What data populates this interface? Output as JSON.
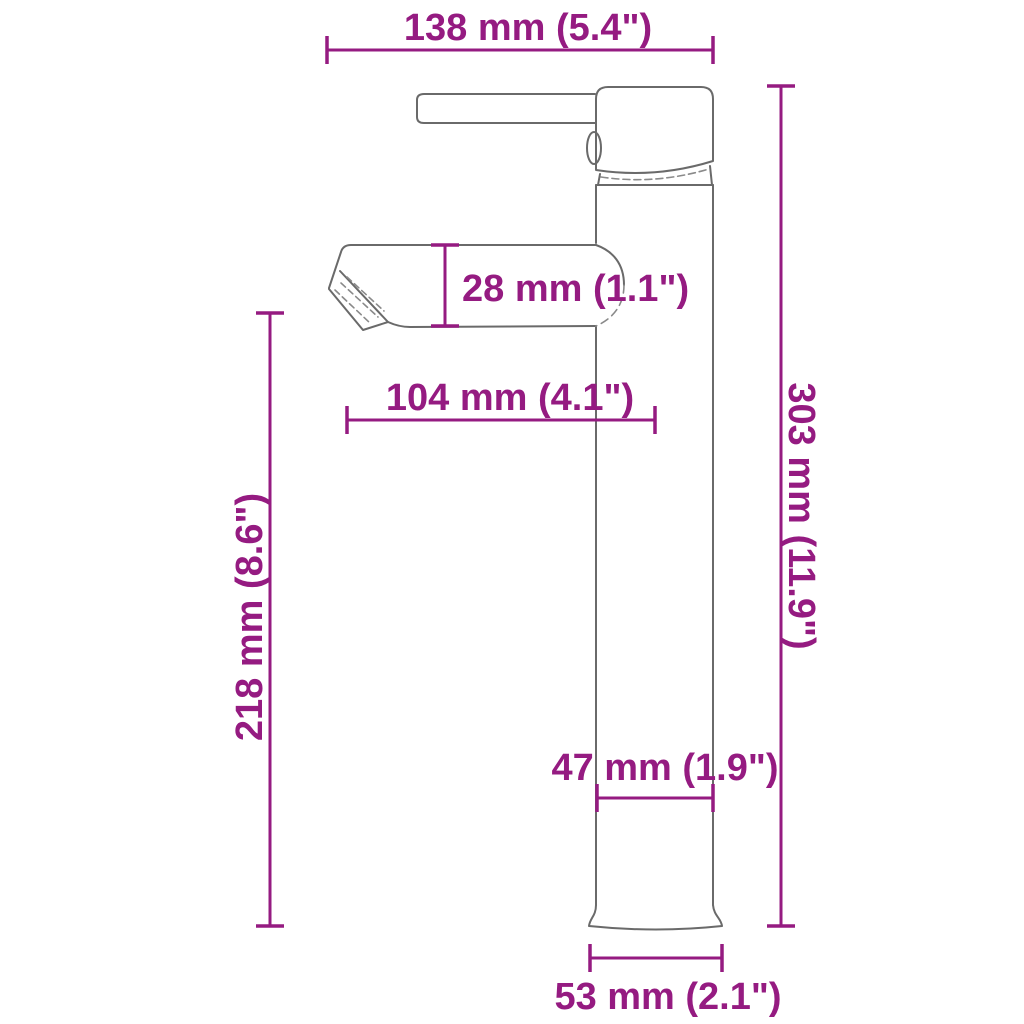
{
  "diagram": {
    "kind": "faucet-dimension-drawing",
    "colors": {
      "dimension_accent": "#951b81",
      "outline_gray": "#6a6a6a"
    },
    "dimensions": {
      "top_width": "138 mm (5.4\")",
      "spout_height": "28 mm (1.1\")",
      "spout_reach": "104 mm (4.1\")",
      "spout_mount_height": "218 mm (8.6\")",
      "total_height": "303 mm (11.9\")",
      "body_width": "47 mm (1.9\")",
      "base_width": "53 mm (2.1\")"
    }
  }
}
